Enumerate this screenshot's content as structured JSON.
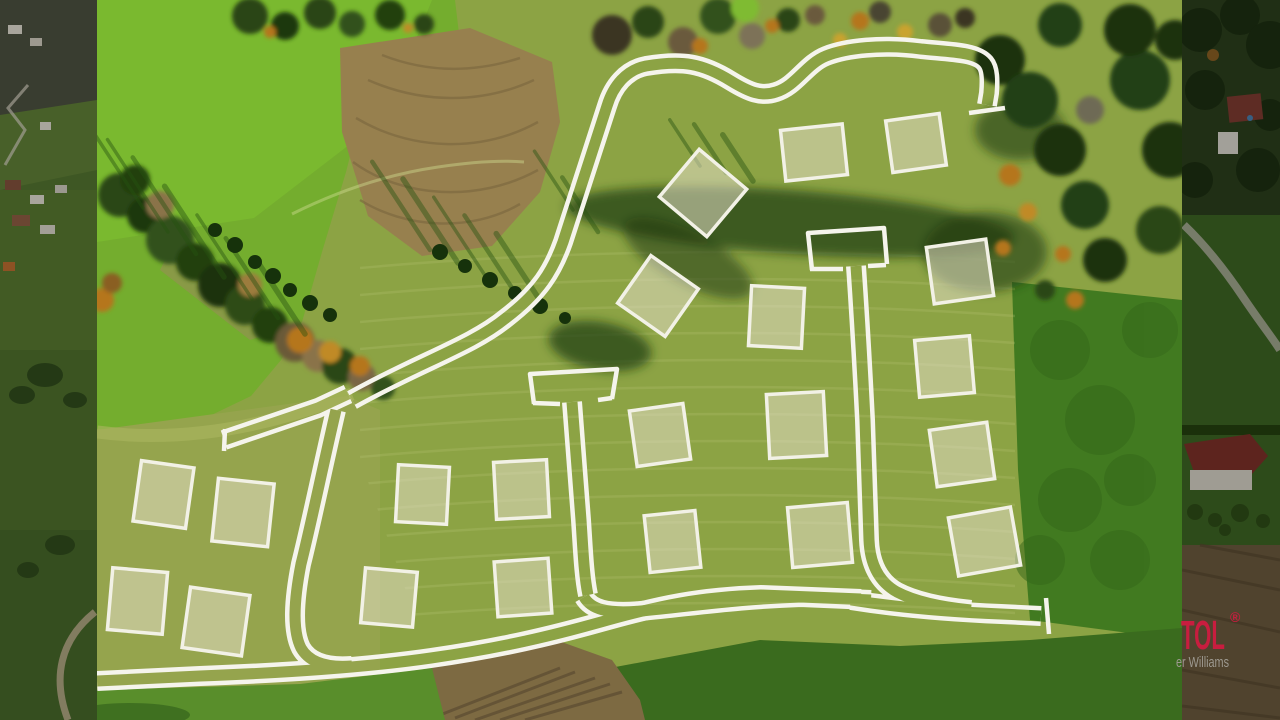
{
  "watermark": {
    "brand_fragment": "TOL",
    "registered_mark": "®",
    "agency_fragment": "er Williams",
    "brand_color": "#c81d3f",
    "agency_color": "#9d9990"
  },
  "palette": {
    "road_line": "#f5f4ec",
    "plot_fill": "rgba(225,220,196,0.55)",
    "plot_line": "#f2f1e6"
  },
  "site_plan": {
    "plot_count": 21,
    "plots": [
      [
        672,
        162,
        62,
        62,
        40
      ],
      [
        783,
        127,
        62,
        51,
        -6
      ],
      [
        889,
        117,
        54,
        52,
        -8
      ],
      [
        629,
        267,
        58,
        58,
        35
      ],
      [
        930,
        243,
        60,
        57,
        -8
      ],
      [
        917,
        338,
        55,
        57,
        -5
      ],
      [
        933,
        426,
        58,
        57,
        -8
      ],
      [
        953,
        512,
        63,
        59,
        -10
      ],
      [
        750,
        287,
        53,
        60,
        3
      ],
      [
        768,
        393,
        57,
        64,
        -3
      ],
      [
        790,
        505,
        60,
        60,
        -5
      ],
      [
        633,
        407,
        54,
        56,
        -8
      ],
      [
        647,
        513,
        51,
        57,
        -6
      ],
      [
        397,
        466,
        51,
        57,
        3
      ],
      [
        363,
        570,
        52,
        55,
        5
      ],
      [
        495,
        461,
        53,
        57,
        -3
      ],
      [
        496,
        560,
        54,
        55,
        -4
      ],
      [
        137,
        464,
        53,
        61,
        8
      ],
      [
        215,
        481,
        56,
        63,
        6
      ],
      [
        110,
        570,
        55,
        62,
        5
      ],
      [
        186,
        591,
        60,
        61,
        8
      ]
    ],
    "roads": [
      "M 352,400 C 420,362 472,346 506,318 C 540,292 553,270 563,242 L 607,106 C 613,86 626,70 646,66 C 682,60 702,63 731,81 C 749,92 761,97 776,92 C 796,86 806,64 826,56 C 846,48 882,44 921,49 C 951,52 976,52 985,63 C 990,69 990,81 989,93 L 987,105",
      "M 224,440 L 318,408 L 348,394",
      "M 336,410 C 322,470 312,520 301,564 C 294,600 292,630 301,648 C 309,662 326,668 352,666",
      "M 97,681 L 200,676 C 280,673 362,668 431,658 C 501,648 551,636 601,622 C 661,605 701,597 761,595 L 861,599",
      "M 584,597 C 591,609 606,614 641,611 C 701,605 741,599 801,597 L 871,600",
      "M 851,600 C 901,608 951,612 1001,614 L 1041,616",
      "M 856,266 C 859,310 862,360 865,420 C 867,470 868,510 869,540 C 870,564 879,582 897,592 C 916,602 941,607 971,610",
      "M 572,402 C 575,440 578,480 581,520 C 583,550 584,576 588,595"
    ],
    "detail_lines": [
      "M 969,113 L 1005,108",
      "M 225,429 L 224,451",
      "M 1046,598 L 1049,634",
      "M 812,270 L 808,233 L 884,228 L 887,264",
      "M 810,269 L 843,269 M 886,265 L 868,266",
      "M 534,404 L 530,374 L 617,369 L 612,399",
      "M 533,403 L 560,404 M 612,398 L 598,400"
    ]
  }
}
